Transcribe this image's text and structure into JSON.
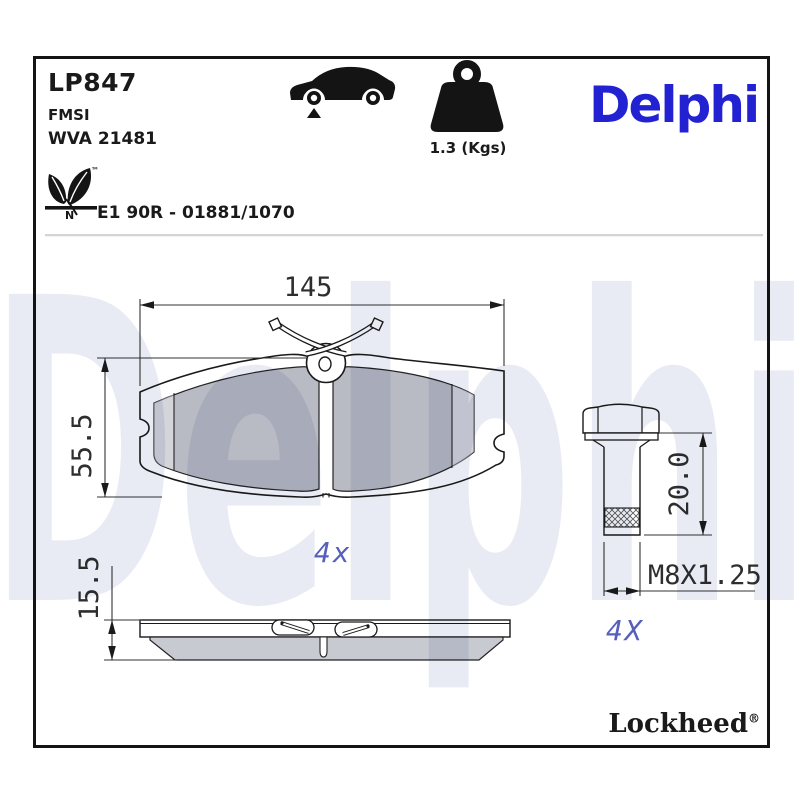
{
  "header": {
    "part_number": "LP847",
    "fmsi_label": "FMSI",
    "wva_number": "WVA 21481",
    "weight_value": "1.3 (Kgs)",
    "brand_logo": "Delphi",
    "approval_text": "E1 90R - 01881/1070",
    "eco_letter": "N",
    "trademark": "™"
  },
  "drawing": {
    "front_view": {
      "width_mm": "145",
      "height_mm": "55.5",
      "quantity_label": "4x"
    },
    "side_view": {
      "thickness_mm": "15.5"
    },
    "bolt": {
      "length_mm": "20.0",
      "thread_spec": "M8X1.25",
      "quantity_label": "4X"
    }
  },
  "watermark": "Delphi",
  "footer": {
    "brand": "Lockheed",
    "registered": "®"
  },
  "colors": {
    "brand_blue": "#2322d2",
    "annotation_blue": "#5560bb",
    "watermark_tint": "#e9ebf4",
    "friction_gray": "#b8bcc6",
    "side_gray": "#c7cad0",
    "line_black": "#1a1a1a"
  }
}
